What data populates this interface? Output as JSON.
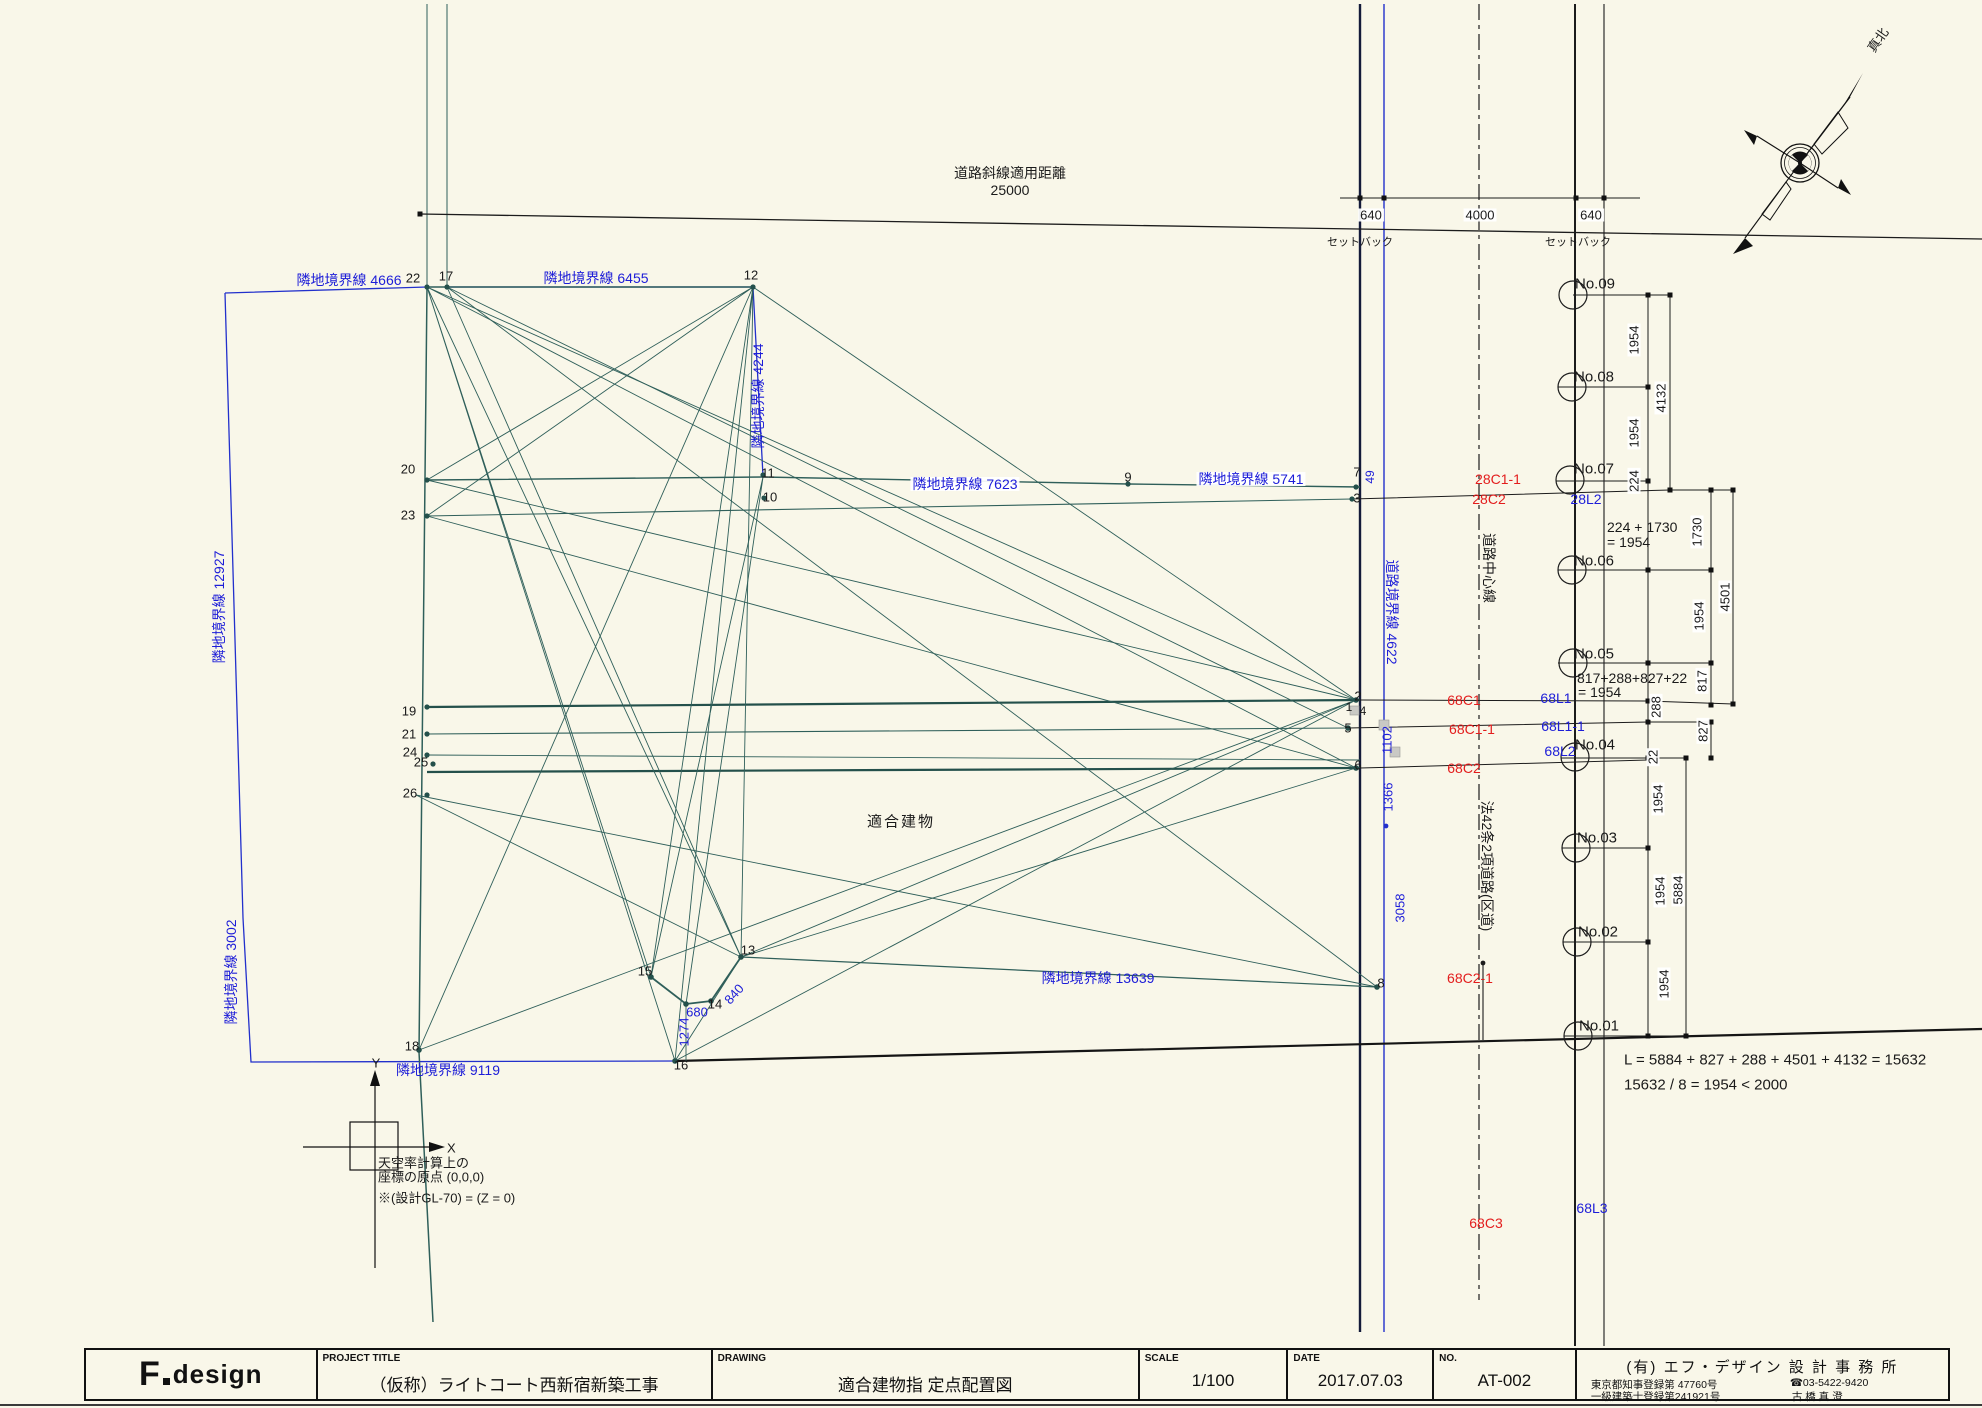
{
  "title_block": {
    "logo_f": "F",
    "logo_design": "design",
    "project_title_label": "PROJECT TITLE",
    "project_title": "（仮称）ライトコート西新宿新築工事",
    "drawing_label": "DRAWING",
    "drawing_title": "適合建物指 定点配置図",
    "scale_label": "SCALE",
    "scale_value": "1/100",
    "date_label": "DATE",
    "date_value": "2017.07.03",
    "no_label": "NO.",
    "no_value": "AT-002",
    "office_name": "(有) エフ・デザイン 設 計 事 務 所",
    "office_reg1": "東京都知事登録第 47760号",
    "office_reg2": "一級建築士登録第241921号",
    "office_tel": "☎03-5422-9420",
    "office_person": "古 橋  真 澄"
  },
  "colors": {
    "background": "#f9f7e9",
    "boundary_blue": "#1d1dd8",
    "station_red": "#e31d1d",
    "site_teal": "#2f5f5a",
    "road_navy": "#141b3a",
    "line_black": "#1c1c1c"
  },
  "labels": [
    {
      "name": "road-slope-distance-label",
      "text": "道路斜線適用距離",
      "x": 1010,
      "y": 173,
      "cls": "k",
      "size": 14
    },
    {
      "name": "road-slope-distance-value",
      "text": "25000",
      "x": 1010,
      "y": 190,
      "cls": "k",
      "size": 14
    },
    {
      "name": "dim-setback-left",
      "text": "640",
      "x": 1371,
      "y": 215,
      "cls": "k",
      "size": 13,
      "bg": 1
    },
    {
      "name": "dim-road-width",
      "text": "4000",
      "x": 1480,
      "y": 215,
      "cls": "k",
      "size": 13,
      "bg": 1
    },
    {
      "name": "dim-setback-right",
      "text": "640",
      "x": 1591,
      "y": 215,
      "cls": "k",
      "size": 13,
      "bg": 1
    },
    {
      "name": "setback-label-left",
      "text": "セットバック",
      "x": 1360,
      "y": 243,
      "cls": "k",
      "size": 11
    },
    {
      "name": "setback-label-right",
      "text": "セットバック",
      "x": 1578,
      "y": 243,
      "cls": "k",
      "size": 11
    },
    {
      "name": "boundary-4666",
      "text": "隣地境界線 4666",
      "x": 349,
      "y": 280,
      "cls": "b",
      "size": 14
    },
    {
      "name": "boundary-6455",
      "text": "隣地境界線 6455",
      "x": 596,
      "y": 278,
      "cls": "b",
      "size": 14
    },
    {
      "name": "boundary-4244",
      "text": "隣地境界線 4244",
      "x": 758,
      "y": 396,
      "cls": "b",
      "size": 14,
      "rot": -90
    },
    {
      "name": "boundary-7623",
      "text": "隣地境界線 7623",
      "x": 965,
      "y": 484,
      "cls": "b",
      "size": 14,
      "bg": 1
    },
    {
      "name": "boundary-5741",
      "text": "隣地境界線 5741",
      "x": 1251,
      "y": 479,
      "cls": "b",
      "size": 14,
      "bg": 1
    },
    {
      "name": "boundary-12927",
      "text": "隣地境界線 12927",
      "x": 219,
      "y": 607,
      "cls": "b",
      "size": 14,
      "rot": -90
    },
    {
      "name": "boundary-3002",
      "text": "隣地境界線 3002",
      "x": 231,
      "y": 972,
      "cls": "b",
      "size": 14,
      "rot": -90
    },
    {
      "name": "boundary-13639",
      "text": "隣地境界線 13639",
      "x": 1098,
      "y": 978,
      "cls": "b",
      "size": 14
    },
    {
      "name": "boundary-9119",
      "text": "隣地境界線 9119",
      "x": 448,
      "y": 1070,
      "cls": "b",
      "size": 14
    },
    {
      "name": "road-boundary-4622",
      "text": "道路境界線 4622",
      "x": 1392,
      "y": 612,
      "cls": "b",
      "size": 14,
      "rot": 90
    },
    {
      "name": "road-centerline-label",
      "text": "道路中心線",
      "x": 1489,
      "y": 568,
      "cls": "k",
      "size": 14,
      "rot": 90
    },
    {
      "name": "road-law42-label",
      "text": "法42条2項道路(区道)",
      "x": 1487,
      "y": 866,
      "cls": "k",
      "size": 14,
      "rot": 90
    },
    {
      "name": "point-22",
      "text": "22",
      "x": 413,
      "y": 278,
      "cls": "k",
      "size": 13
    },
    {
      "name": "point-17",
      "text": "17",
      "x": 446,
      "y": 276,
      "cls": "k",
      "size": 13
    },
    {
      "name": "point-12",
      "text": "12",
      "x": 751,
      "y": 275,
      "cls": "k",
      "size": 13
    },
    {
      "name": "point-20",
      "text": "20",
      "x": 408,
      "y": 469,
      "cls": "k",
      "size": 13
    },
    {
      "name": "point-23",
      "text": "23",
      "x": 408,
      "y": 515,
      "cls": "k",
      "size": 13
    },
    {
      "name": "point-11",
      "text": "11",
      "x": 768,
      "y": 473,
      "cls": "k",
      "size": 13
    },
    {
      "name": "point-10",
      "text": "10",
      "x": 770,
      "y": 497,
      "cls": "k",
      "size": 13
    },
    {
      "name": "point-9",
      "text": "9",
      "x": 1128,
      "y": 477,
      "cls": "k",
      "size": 13
    },
    {
      "name": "point-7",
      "text": "7",
      "x": 1357,
      "y": 472,
      "cls": "k",
      "size": 13
    },
    {
      "name": "point-3",
      "text": "3",
      "x": 1357,
      "y": 498,
      "cls": "k",
      "size": 13
    },
    {
      "name": "point-2",
      "text": "2",
      "x": 1358,
      "y": 696,
      "cls": "k",
      "size": 13
    },
    {
      "name": "point-1",
      "text": "1",
      "x": 1349,
      "y": 707,
      "cls": "k",
      "size": 12
    },
    {
      "name": "point-4",
      "text": "4",
      "x": 1363,
      "y": 711,
      "cls": "k",
      "size": 12
    },
    {
      "name": "point-5",
      "text": "5",
      "x": 1348,
      "y": 728,
      "cls": "k",
      "size": 13
    },
    {
      "name": "point-6",
      "text": "6",
      "x": 1358,
      "y": 765,
      "cls": "k",
      "size": 13
    },
    {
      "name": "point-19",
      "text": "19",
      "x": 409,
      "y": 711,
      "cls": "k",
      "size": 13
    },
    {
      "name": "point-21",
      "text": "21",
      "x": 409,
      "y": 734,
      "cls": "k",
      "size": 13
    },
    {
      "name": "point-24",
      "text": "24",
      "x": 410,
      "y": 752,
      "cls": "k",
      "size": 13
    },
    {
      "name": "point-25",
      "text": "25",
      "x": 421,
      "y": 762,
      "cls": "k",
      "size": 13
    },
    {
      "name": "point-26",
      "text": "26",
      "x": 410,
      "y": 793,
      "cls": "k",
      "size": 13
    },
    {
      "name": "point-13",
      "text": "13",
      "x": 748,
      "y": 950,
      "cls": "k",
      "size": 13
    },
    {
      "name": "point-15",
      "text": "15",
      "x": 645,
      "y": 971,
      "cls": "k",
      "size": 13
    },
    {
      "name": "point-14",
      "text": "14",
      "x": 715,
      "y": 1004,
      "cls": "k",
      "size": 13
    },
    {
      "name": "point-16",
      "text": "16",
      "x": 681,
      "y": 1065,
      "cls": "k",
      "size": 13
    },
    {
      "name": "point-18",
      "text": "18",
      "x": 412,
      "y": 1046,
      "cls": "k",
      "size": 13
    },
    {
      "name": "point-8",
      "text": "8",
      "x": 1381,
      "y": 983,
      "cls": "k",
      "size": 13
    },
    {
      "name": "dim-49",
      "text": "49",
      "x": 1370,
      "y": 477,
      "cls": "b",
      "size": 12,
      "rot": -90
    },
    {
      "name": "dim-680",
      "text": "680",
      "x": 697,
      "y": 1012,
      "cls": "b",
      "size": 13
    },
    {
      "name": "dim-840",
      "text": "840",
      "x": 734,
      "y": 994,
      "cls": "b",
      "size": 13,
      "rot": -48
    },
    {
      "name": "dim-1274",
      "text": "1274",
      "x": 684,
      "y": 1032,
      "cls": "b",
      "size": 13,
      "rot": -90
    },
    {
      "name": "dim-1102",
      "text": "1102",
      "x": 1387,
      "y": 740,
      "cls": "b",
      "size": 13,
      "rot": -90
    },
    {
      "name": "dim-1366",
      "text": "1366",
      "x": 1388,
      "y": 797,
      "cls": "b",
      "size": 13,
      "rot": -90
    },
    {
      "name": "dim-3058",
      "text": "3058",
      "x": 1400,
      "y": 908,
      "cls": "b",
      "size": 13,
      "rot": -90
    },
    {
      "name": "station-28c1-1",
      "text": "28C1-1",
      "x": 1498,
      "y": 479,
      "cls": "r",
      "size": 14
    },
    {
      "name": "station-28c2",
      "text": "28C2",
      "x": 1489,
      "y": 499,
      "cls": "r",
      "size": 14
    },
    {
      "name": "station-28l2",
      "text": "28L2",
      "x": 1586,
      "y": 499,
      "cls": "b",
      "size": 14
    },
    {
      "name": "station-68c1",
      "text": "68C1",
      "x": 1464,
      "y": 700,
      "cls": "r",
      "size": 14
    },
    {
      "name": "station-68l1",
      "text": "68L1",
      "x": 1556,
      "y": 698,
      "cls": "b",
      "size": 14
    },
    {
      "name": "station-68c1-1",
      "text": "68C1-1",
      "x": 1472,
      "y": 729,
      "cls": "r",
      "size": 14
    },
    {
      "name": "station-68l1-1",
      "text": "68L1-1",
      "x": 1563,
      "y": 726,
      "cls": "b",
      "size": 14
    },
    {
      "name": "station-68c2",
      "text": "68C2",
      "x": 1464,
      "y": 768,
      "cls": "r",
      "size": 14
    },
    {
      "name": "station-68l2",
      "text": "68L2",
      "x": 1560,
      "y": 751,
      "cls": "b",
      "size": 14
    },
    {
      "name": "station-68c2-1",
      "text": "68C2-1",
      "x": 1470,
      "y": 978,
      "cls": "r",
      "size": 14
    },
    {
      "name": "station-68c3",
      "text": "68C3",
      "x": 1486,
      "y": 1223,
      "cls": "r",
      "size": 14
    },
    {
      "name": "station-68l3",
      "text": "68L3",
      "x": 1592,
      "y": 1208,
      "cls": "b",
      "size": 14
    },
    {
      "name": "survey-no09",
      "text": "No.09",
      "x": 1595,
      "y": 284,
      "cls": "k",
      "size": 15
    },
    {
      "name": "survey-no08",
      "text": "No.08",
      "x": 1594,
      "y": 377,
      "cls": "k",
      "size": 15
    },
    {
      "name": "survey-no07",
      "text": "No.07",
      "x": 1594,
      "y": 469,
      "cls": "k",
      "size": 15
    },
    {
      "name": "survey-no06",
      "text": "No.06",
      "x": 1594,
      "y": 561,
      "cls": "k",
      "size": 15
    },
    {
      "name": "survey-no05",
      "text": "No.05",
      "x": 1594,
      "y": 654,
      "cls": "k",
      "size": 15
    },
    {
      "name": "survey-no04",
      "text": "No.04",
      "x": 1595,
      "y": 745,
      "cls": "k",
      "size": 15
    },
    {
      "name": "survey-no03",
      "text": "No.03",
      "x": 1597,
      "y": 838,
      "cls": "k",
      "size": 15
    },
    {
      "name": "survey-no02",
      "text": "No.02",
      "x": 1598,
      "y": 932,
      "cls": "k",
      "size": 15
    },
    {
      "name": "survey-no01",
      "text": "No.01",
      "x": 1599,
      "y": 1026,
      "cls": "k",
      "size": 15
    },
    {
      "name": "dim-1954-a",
      "text": "1954",
      "x": 1634,
      "y": 340,
      "cls": "k",
      "size": 13,
      "rot": -90,
      "bg": 1
    },
    {
      "name": "dim-4132",
      "text": "4132",
      "x": 1661,
      "y": 398,
      "cls": "k",
      "size": 13,
      "rot": -90,
      "bg": 1
    },
    {
      "name": "dim-1954-b",
      "text": "1954",
      "x": 1634,
      "y": 433,
      "cls": "k",
      "size": 13,
      "rot": -90,
      "bg": 1
    },
    {
      "name": "dim-224",
      "text": "224",
      "x": 1634,
      "y": 481,
      "cls": "k",
      "size": 13,
      "rot": -90,
      "bg": 1
    },
    {
      "name": "dim-1730",
      "text": "1730",
      "x": 1697,
      "y": 532,
      "cls": "k",
      "size": 13,
      "rot": -90,
      "bg": 1
    },
    {
      "name": "dim-4501",
      "text": "4501",
      "x": 1725,
      "y": 597,
      "cls": "k",
      "size": 13,
      "rot": -90,
      "bg": 1
    },
    {
      "name": "dim-1954-c",
      "text": "1954",
      "x": 1699,
      "y": 616,
      "cls": "k",
      "size": 13,
      "rot": -90,
      "bg": 1
    },
    {
      "name": "dim-817",
      "text": "817",
      "x": 1702,
      "y": 681,
      "cls": "k",
      "size": 13,
      "rot": -90,
      "bg": 1
    },
    {
      "name": "dim-288",
      "text": "288",
      "x": 1656,
      "y": 707,
      "cls": "k",
      "size": 13,
      "rot": -90,
      "bg": 1
    },
    {
      "name": "dim-827",
      "text": "827",
      "x": 1703,
      "y": 731,
      "cls": "k",
      "size": 13,
      "rot": -90,
      "bg": 1
    },
    {
      "name": "dim-22",
      "text": "22",
      "x": 1653,
      "y": 757,
      "cls": "k",
      "size": 13,
      "rot": -90,
      "bg": 1
    },
    {
      "name": "dim-1954-d",
      "text": "1954",
      "x": 1658,
      "y": 799,
      "cls": "k",
      "size": 13,
      "rot": -90,
      "bg": 1
    },
    {
      "name": "dim-5884",
      "text": "5884",
      "x": 1678,
      "y": 890,
      "cls": "k",
      "size": 13,
      "rot": -90,
      "bg": 1
    },
    {
      "name": "dim-1954-e",
      "text": "1954",
      "x": 1660,
      "y": 891,
      "cls": "k",
      "size": 13,
      "rot": -90,
      "bg": 1
    },
    {
      "name": "dim-1954-f",
      "text": "1954",
      "x": 1664,
      "y": 984,
      "cls": "k",
      "size": 13,
      "rot": -90,
      "bg": 1
    },
    {
      "name": "calc-224-1730-line1",
      "text": "224 + 1730",
      "x": 1607,
      "y": 527,
      "cls": "k",
      "size": 14,
      "anchor": "l"
    },
    {
      "name": "calc-224-1730-line2",
      "text": "= 1954",
      "x": 1607,
      "y": 542,
      "cls": "k",
      "size": 14,
      "anchor": "l"
    },
    {
      "name": "calc-817-line1",
      "text": "817+288+827+22",
      "x": 1577,
      "y": 678,
      "cls": "k",
      "size": 14,
      "anchor": "l"
    },
    {
      "name": "calc-817-line2",
      "text": "= 1954",
      "x": 1578,
      "y": 692,
      "cls": "k",
      "size": 14,
      "anchor": "l"
    },
    {
      "name": "formula-total-length",
      "text": "L = 5884 + 827 + 288 + 4501 + 4132 = 15632",
      "x": 1624,
      "y": 1060,
      "cls": "k",
      "size": 15,
      "anchor": "l"
    },
    {
      "name": "formula-division",
      "text": "15632 / 8 = 1954  < 2000",
      "x": 1624,
      "y": 1085,
      "cls": "k",
      "size": 15,
      "anchor": "l"
    },
    {
      "name": "building-label",
      "text": "適合建物",
      "x": 901,
      "y": 822,
      "cls": "k",
      "size": 15,
      "ls": 2
    },
    {
      "name": "origin-note-line1",
      "text": "天空率計算上の",
      "x": 378,
      "y": 1163,
      "cls": "k",
      "size": 13,
      "anchor": "l"
    },
    {
      "name": "origin-note-line2",
      "text": "座標の原点 (0,0,0)",
      "x": 378,
      "y": 1177,
      "cls": "k",
      "size": 13,
      "anchor": "l"
    },
    {
      "name": "origin-note-line3",
      "text": "※(設計GL-70) = (Z = 0)",
      "x": 378,
      "y": 1198,
      "cls": "k",
      "size": 13,
      "anchor": "l"
    },
    {
      "name": "axis-x-label",
      "text": "X",
      "x": 447,
      "y": 1148,
      "cls": "k",
      "size": 13,
      "anchor": "l"
    },
    {
      "name": "axis-y-label",
      "text": "Y",
      "x": 376,
      "y": 1063,
      "cls": "k",
      "size": 13
    },
    {
      "name": "compass-label",
      "text": "真北",
      "x": 1878,
      "y": 40,
      "cls": "k",
      "size": 13,
      "rot": -55
    }
  ]
}
